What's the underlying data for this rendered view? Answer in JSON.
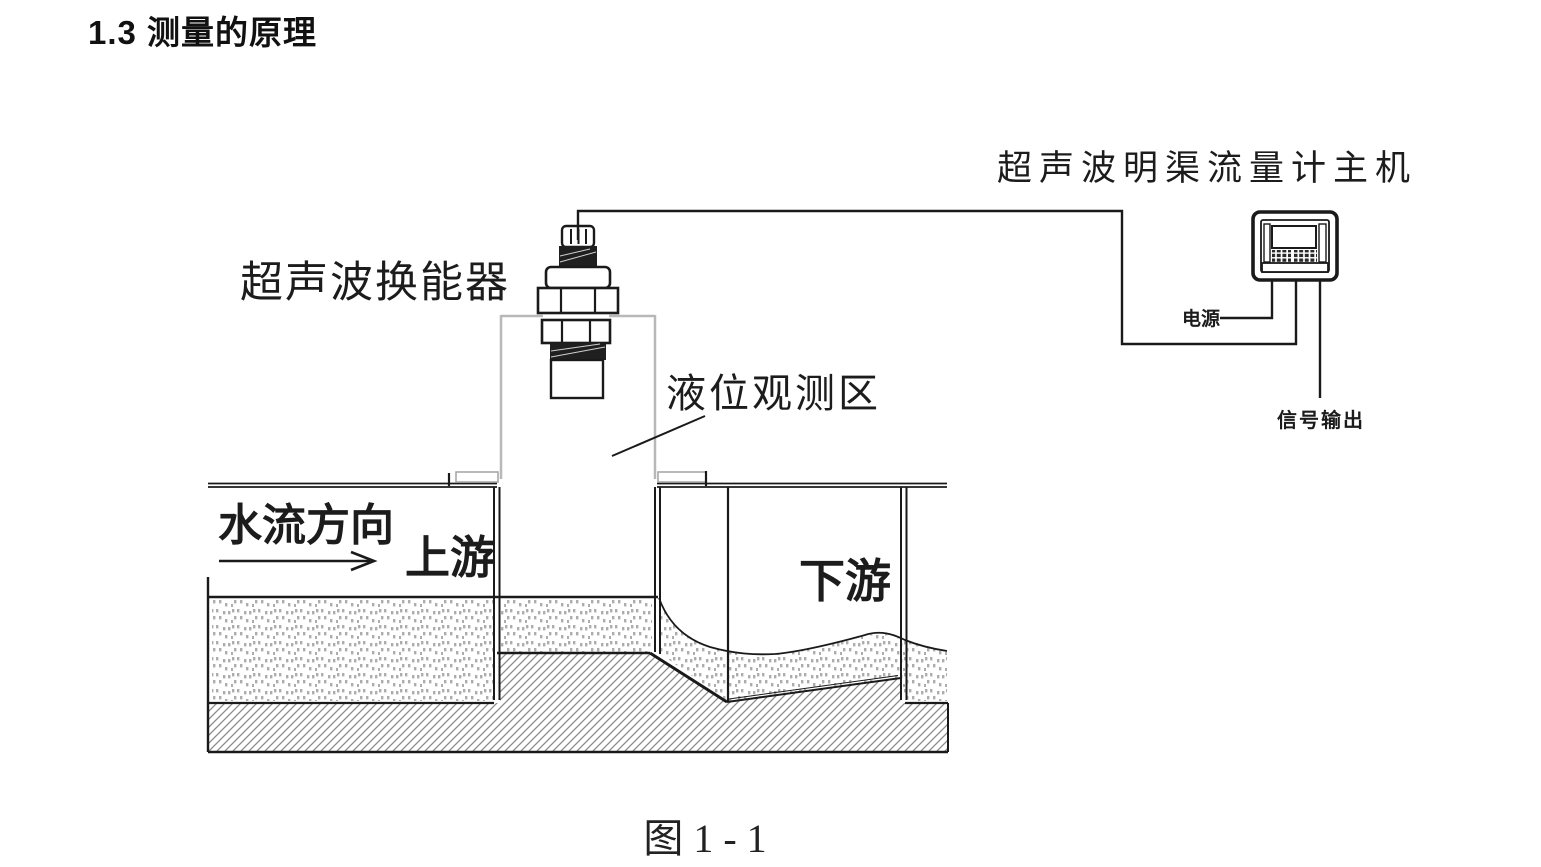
{
  "document": {
    "heading": "1.3 测量的原理",
    "figure_caption": "图 1 - 1"
  },
  "diagram": {
    "labels": {
      "main_unit": "超声波明渠流量计主机",
      "transducer": "超声波换能器",
      "level_observation_zone": "液位观测区",
      "flow_direction": "水流方向",
      "upstream": "上游",
      "downstream": "下游",
      "power": "电源",
      "signal_output": "信号输出"
    },
    "colors": {
      "line_black": "#1a1a1a",
      "pillar_gray": "#b8b8b8",
      "hatch_gray": "#8a8a8a",
      "water_dot_gray": "#999999",
      "background": "#ffffff"
    }
  }
}
